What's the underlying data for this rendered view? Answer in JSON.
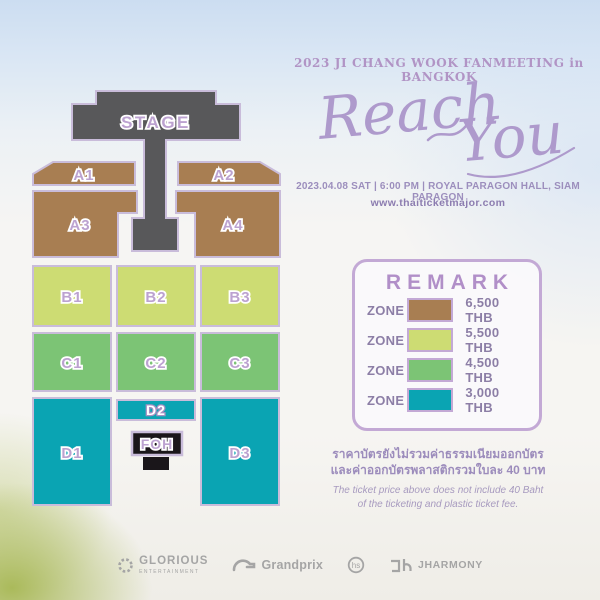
{
  "header": {
    "event_title": "2023 JI CHANG WOOK FANMEETING in BANGKOK",
    "script_word1": "Reach",
    "script_word2": "You",
    "date_line": "2023.04.08 SAT | 6:00 PM | ROYAL PARAGON HALL, SIAM PARAGON",
    "website": "www.thaiticketmajor.com"
  },
  "seat_map": {
    "stage_label": "STAGE",
    "foh_label": "FOH",
    "zones": [
      {
        "label": "A1"
      },
      {
        "label": "A2"
      },
      {
        "label": "A3"
      },
      {
        "label": "A4"
      },
      {
        "label": "B1"
      },
      {
        "label": "B2"
      },
      {
        "label": "B3"
      },
      {
        "label": "C1"
      },
      {
        "label": "C2"
      },
      {
        "label": "C3"
      },
      {
        "label": "D1"
      },
      {
        "label": "D2"
      },
      {
        "label": "D3"
      }
    ]
  },
  "remark": {
    "title": "REMARK",
    "rows": [
      {
        "zone_label": "ZONE",
        "color": "#A87E52",
        "price": "6,500 THB"
      },
      {
        "zone_label": "ZONE",
        "color": "#CDDC73",
        "price": "5,500 THB"
      },
      {
        "zone_label": "ZONE",
        "color": "#7CC475",
        "price": "4,500 THB"
      },
      {
        "zone_label": "ZONE",
        "color": "#0AA4B3",
        "price": "3,000 THB"
      }
    ]
  },
  "notes": {
    "thai_line1": "ราคาบัตรยังไม่รวมค่าธรรมเนียมออกบัตร",
    "thai_line2": "และค่าออกบัตรพลาสติกรวมใบละ 40 บาท",
    "en_line1": "The ticket price above does not include 40 Baht",
    "en_line2": "of the ticketing and plastic ticket fee."
  },
  "sponsors": {
    "glorious": {
      "name": "GLORIOUS",
      "sub": "ENTERTAINMENT"
    },
    "grandprix": {
      "name": "Grandprix"
    },
    "hs": {
      "name": "hs"
    },
    "jharmony": {
      "name": "JHARMONY"
    }
  },
  "colors": {
    "zone_a": "#A87E52",
    "zone_b": "#CDDC73",
    "zone_c": "#7CC475",
    "zone_d": "#0AA4B3",
    "stage": "#58585A",
    "foh": "#1A161A",
    "outline": "#C9BCDA",
    "accent_purple": "#B194C5"
  }
}
